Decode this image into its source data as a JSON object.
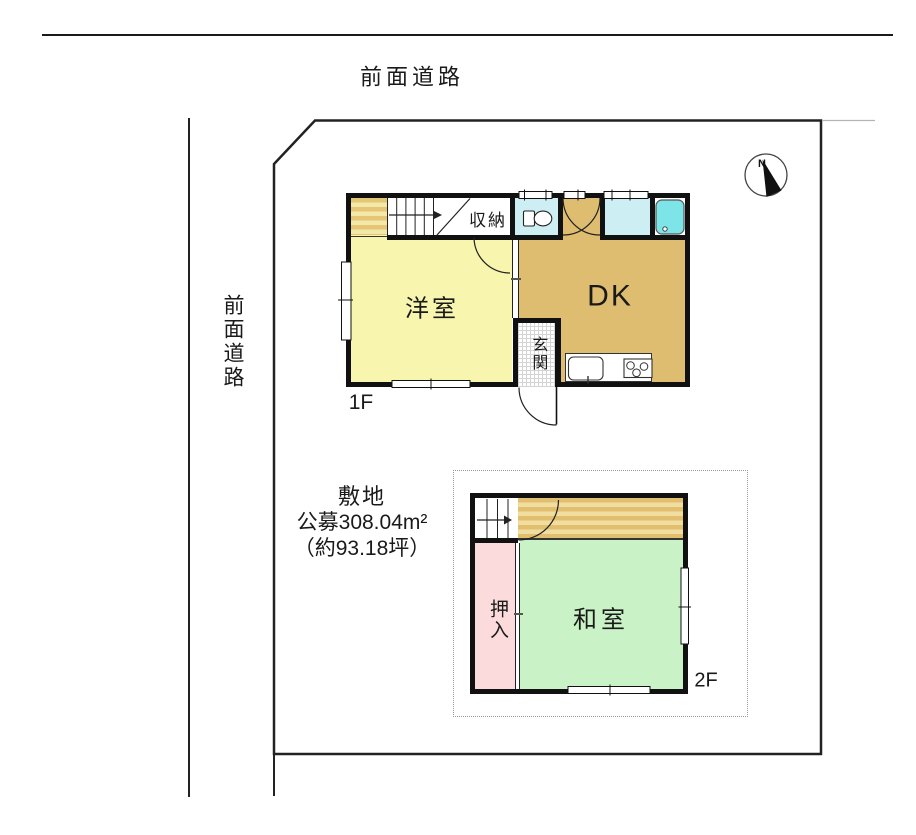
{
  "roads": {
    "top_label": "前面道路",
    "left_label": "前面道路"
  },
  "site": {
    "title": "敷地",
    "area_m2": "公募308.04m²",
    "area_tsubo": "（約93.18坪）"
  },
  "compass": {
    "north": "N"
  },
  "floor1": {
    "label": "1F",
    "rooms": {
      "western_room": "洋室",
      "dk": "DK",
      "storage": "収納",
      "entrance": "玄関"
    }
  },
  "floor2": {
    "label": "2F",
    "rooms": {
      "japanese_room": "和室",
      "closet": "押入"
    }
  },
  "colors": {
    "wall": "#111111",
    "western_room": "#f8f5ae",
    "dk": "#dfbd70",
    "wet_area": "#cdeef2",
    "bathtub": "#7de4e8",
    "japanese_room": "#c9f2c6",
    "closet": "#fbdbdb",
    "stripe_dark": "#e5c576",
    "stripe_light": "#f4e8a8",
    "outline": "#222222"
  }
}
